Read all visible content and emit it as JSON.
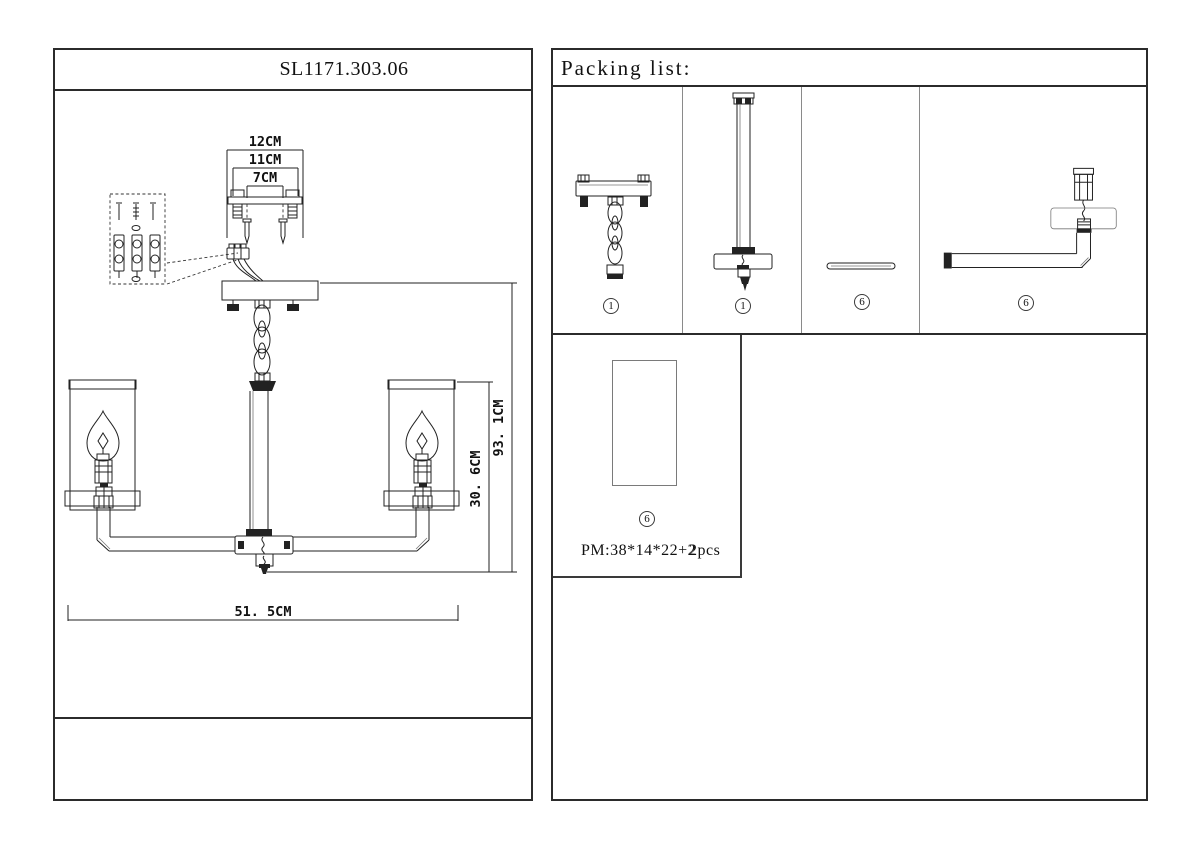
{
  "left_panel": {
    "title": "SL1171.303.06",
    "dims": {
      "bracket_outer": "12CM",
      "bracket_mid": "11CM",
      "bracket_inner": "7CM",
      "height_total": "93. 1CM",
      "height_body": "30. 6CM",
      "width_total": "51. 5CM"
    }
  },
  "packing": {
    "title": "Packing list:",
    "parts": [
      {
        "num": "1"
      },
      {
        "num": "1"
      },
      {
        "num": "6"
      },
      {
        "num": "6"
      }
    ],
    "shade_box": {
      "num": "6",
      "size": "PM:38*14*22+2",
      "qty": "2pcs"
    }
  }
}
